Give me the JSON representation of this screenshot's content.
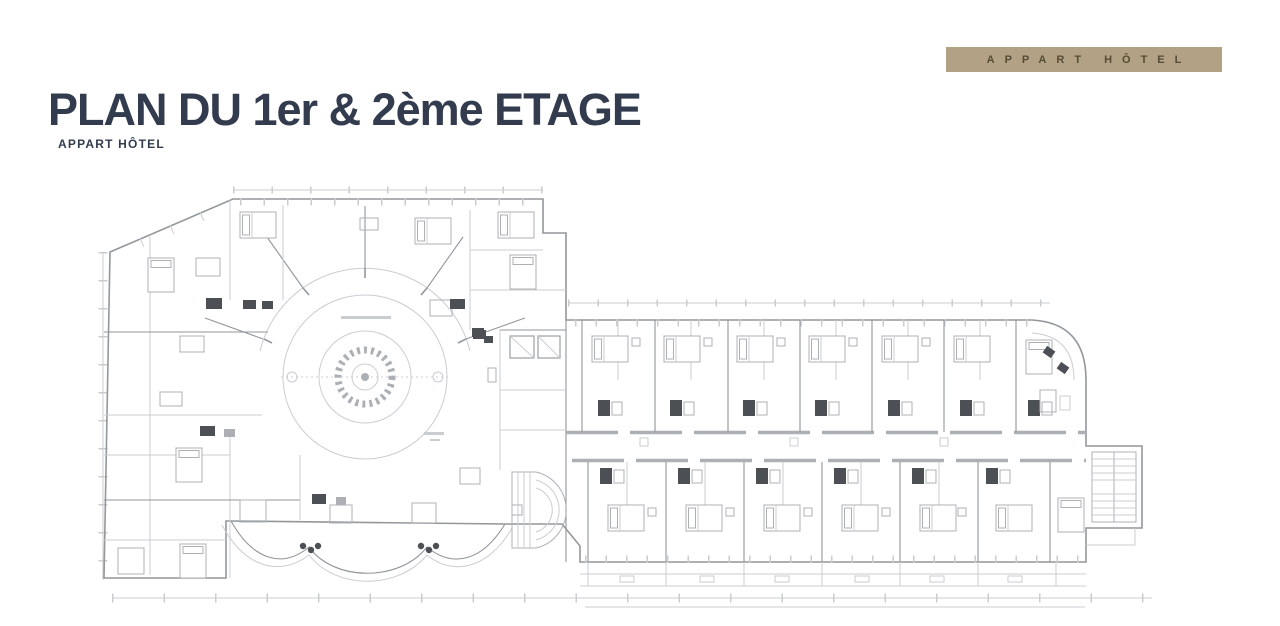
{
  "header": {
    "title": "PLAN DU 1er & 2ème ETAGE",
    "subtitle": "APPART HÔTEL"
  },
  "badge": {
    "label": "APPART HÔTEL"
  },
  "colors": {
    "ink": "#333b4e",
    "badge-bg": "#b2a184",
    "badge-text": "#564c36",
    "paper": "#ffffff",
    "wall": "#8e9398",
    "mid": "#a9adb2",
    "light": "#c8cbcf",
    "dark": "#45494f"
  }
}
